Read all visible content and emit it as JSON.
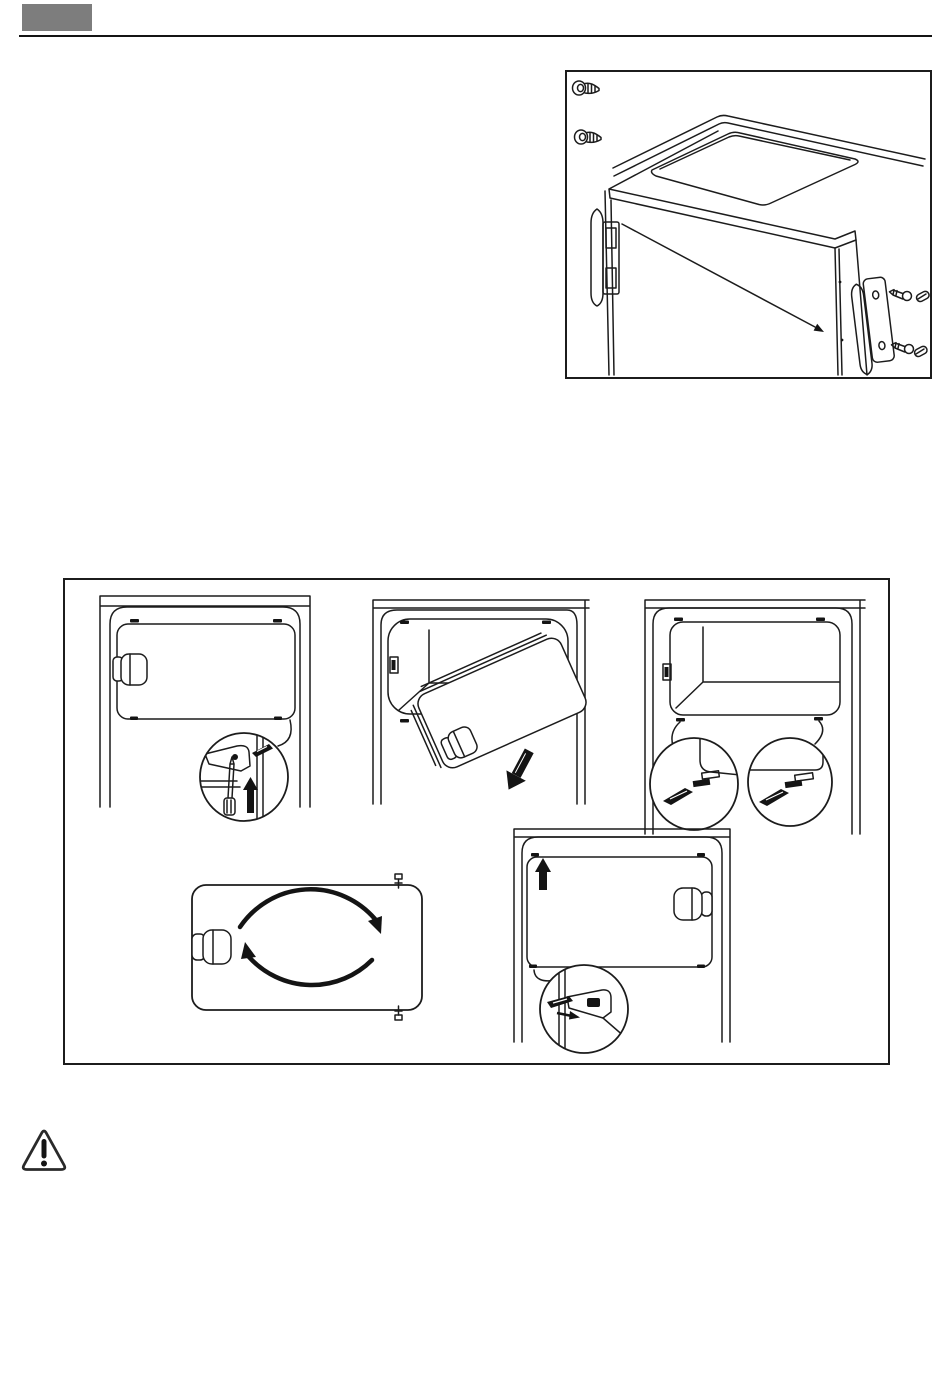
{
  "page": {
    "label": "Appliance instruction manual page (no visible text, line-art only)",
    "colors": {
      "background": "#ffffff",
      "line": "#1c1c1c",
      "header_block": "#7d7d7d",
      "header_rule": "#141414",
      "solid_fill": "#141414"
    },
    "header": {
      "block_label": "chapter marker block",
      "rule_label": "header horizontal rule"
    },
    "figures": {
      "handle_mounting": {
        "label": "Door handle mounting illustration: fridge top corner with handle, screws, caps and wall plugs",
        "icons": [
          "wall-plug-icon",
          "wall-plug-icon",
          "door-handle",
          "screw-icon",
          "screw-cap-icon",
          "screw-icon",
          "screw-cap-icon",
          "pointer-arrow-icon"
        ]
      },
      "flap_reversal": {
        "label": "Freezer compartment flap door-reversal sequence, five steps",
        "steps": [
          {
            "label": "Step 1: closed flap; magnified detail shows screwdriver pushing hinge pin upward"
          },
          {
            "label": "Step 2: flap tilted and lifted out of the opening, arrow pointing down"
          },
          {
            "label": "Step 3: empty opening; magnified details show plugs moved to the opposite holes"
          },
          {
            "label": "Step 4: flap rotated 180 degrees, circular arrows"
          },
          {
            "label": "Step 5: flap refitted with handle on opposite side; magnified detail shows pin inserted"
          }
        ]
      },
      "warning": {
        "label": "Warning triangle with exclamation mark"
      }
    }
  }
}
